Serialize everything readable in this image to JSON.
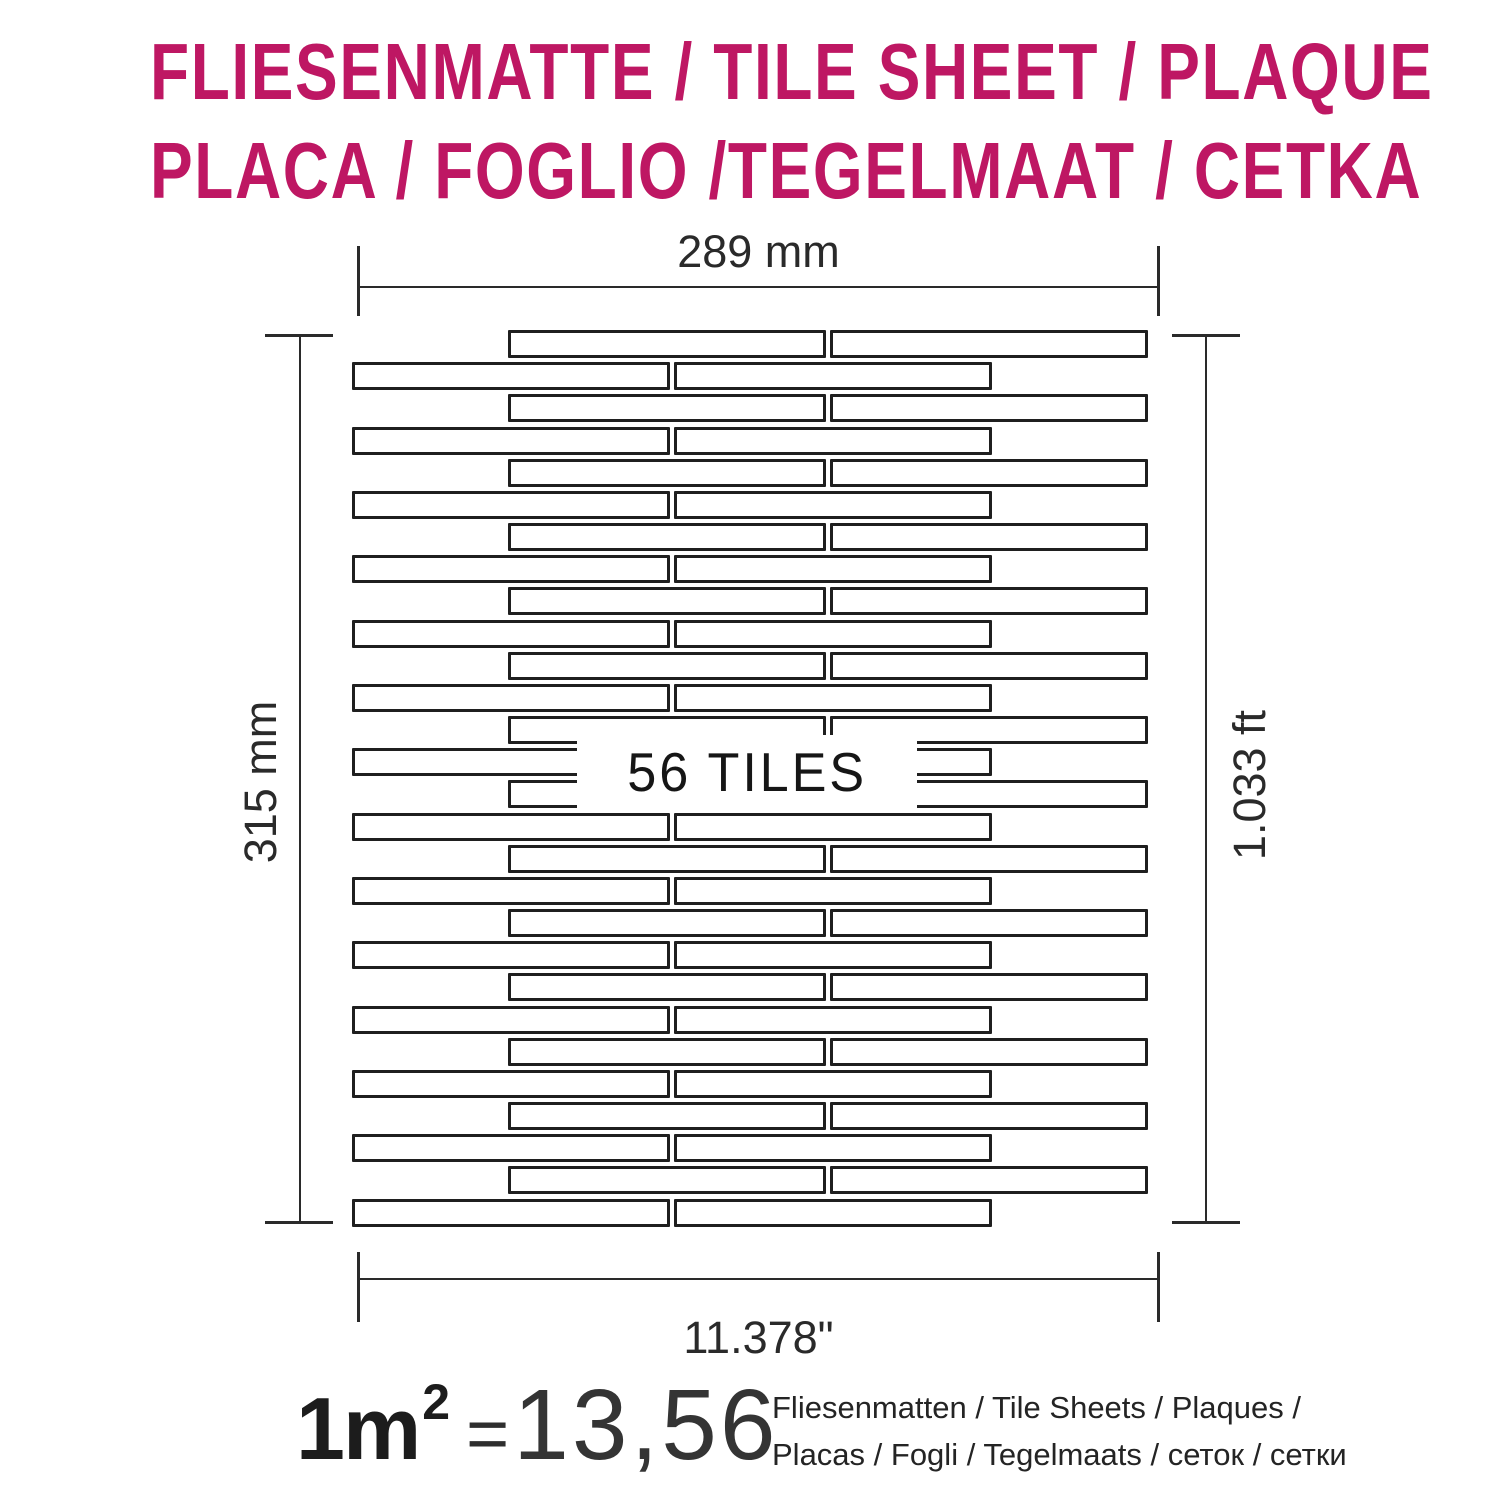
{
  "title": {
    "line1": "FLIESENMATTE / TILE SHEET / PLAQUE",
    "line2": "PLACA / FOGLIO /TEGELMAAT / CETKA",
    "color": "#be1763"
  },
  "diagram": {
    "width_label_mm": "289 mm",
    "width_label_in": "11.378\"",
    "height_label_mm": "315 mm",
    "height_label_ft": "1.033 ft",
    "tiles_label": "56 TILES",
    "sheet": {
      "rows": 28,
      "tiles_per_row": 2,
      "tile_count": 56,
      "tile_fill": "#ffffff",
      "tile_border": "#1f1f1f"
    }
  },
  "formula": {
    "lhs": "1m",
    "exponent": "2",
    "equals": "=",
    "value": "13,56",
    "caption_line1": "Fliesenmatten / Tile Sheets / Plaques /",
    "caption_line2": "Placas / Fogli / Tegelmaats / сеток / сетки"
  }
}
